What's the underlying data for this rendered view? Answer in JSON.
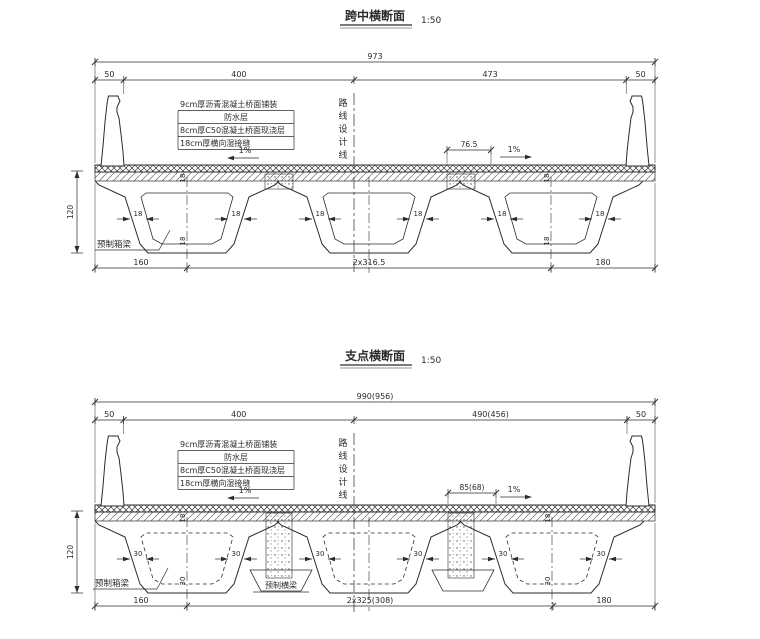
{
  "drawing": {
    "ink": "#2b2b2b",
    "background": "#ffffff",
    "sections": [
      {
        "id": "midspan-cross-section",
        "title": "跨中横断面",
        "scale": "1:50",
        "centerline_label": "路线设计线",
        "girder_label": "预制箱梁",
        "annotations": [
          "9cm厚沥青混凝土桥面铺装",
          "防水层",
          "8cm厚C50混凝土桥面现浇层",
          "18cm厚横向湿接缝"
        ],
        "dims": {
          "total": "973",
          "segments": [
            "50",
            "400",
            "473",
            "50"
          ],
          "deck_offset": "76.5",
          "slope_left": "1%",
          "slope_right": "1%",
          "girder_height": "120",
          "bottom": [
            "160",
            "2x316.5",
            "180"
          ],
          "web_thickness": "18",
          "top_slab": "18",
          "bottom_slab": "18"
        }
      },
      {
        "id": "support-cross-section",
        "title": "支点横断面",
        "scale": "1:50",
        "centerline_label": "路线设计线",
        "girder_label": "预制箱梁",
        "diaphragm_label": "预制横梁",
        "annotations": [
          "9cm厚沥青混凝土桥面铺装",
          "防水层",
          "8cm厚C50混凝土桥面现浇层",
          "18cm厚横向湿接缝"
        ],
        "dims": {
          "total": "990(956)",
          "segments": [
            "50",
            "400",
            "490(456)",
            "50"
          ],
          "deck_offset": "85(68)",
          "slope_left": "1%",
          "slope_right": "1%",
          "girder_height": "120",
          "bottom": [
            "160",
            "2x325(308)",
            "180"
          ],
          "web_thickness": "30",
          "top_slab": "18",
          "bottom_slab": "30"
        }
      }
    ]
  }
}
